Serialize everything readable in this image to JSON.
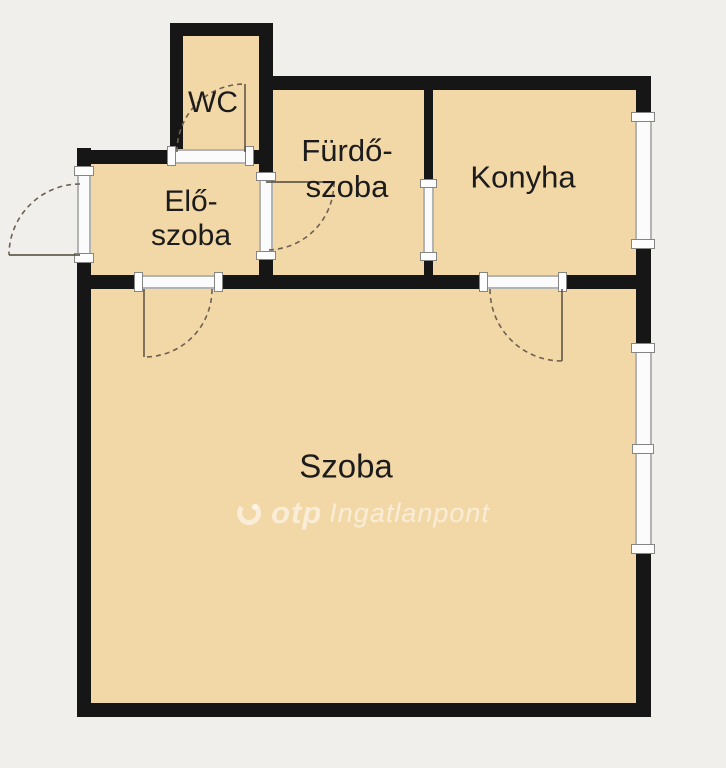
{
  "rooms": {
    "wc": {
      "label": "WC"
    },
    "furdo": {
      "line1": "Fürdő-",
      "line2": "szoba"
    },
    "konyha": {
      "label": "Konyha"
    },
    "elo": {
      "line1": "Elő-",
      "line2": "szoba"
    },
    "szoba": {
      "label": "Szoba"
    }
  },
  "watermark": {
    "brand": "otp",
    "text": "Ingatlanpont",
    "logo_icon": "otp-circle-logo"
  },
  "colors": {
    "background": "#f0efeb",
    "room_fill": "#f3d8a7",
    "wall": "#161616",
    "label_text": "#1c1c1c",
    "door_swing": "#6e6152",
    "window_frame": "#b3b3b3",
    "watermark": "rgba(255,255,255,0.55)"
  },
  "elements": {
    "doors": [
      "entrance-door",
      "wc-door",
      "bathroom-door",
      "bathroom-kitchen-opening",
      "hall-room-door",
      "kitchen-room-door"
    ],
    "windows": [
      "kitchen-window",
      "room-window"
    ]
  }
}
